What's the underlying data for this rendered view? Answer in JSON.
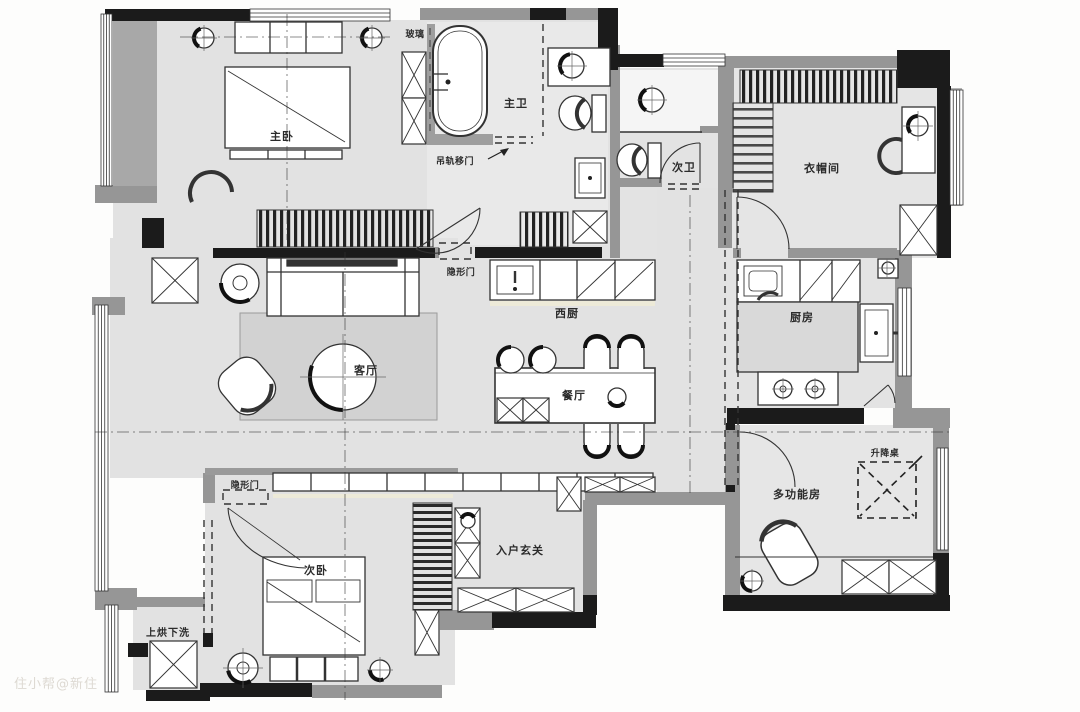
{
  "title": "apartment-floor-plan",
  "watermark": "住小帮@新住",
  "rooms": {
    "master_bedroom": "主卧",
    "master_bath": "主卫",
    "second_bath": "次卫",
    "cloakroom": "衣帽间",
    "living_room": "客厅",
    "west_kitchen": "西厨",
    "dining_room": "餐厅",
    "kitchen": "厨房",
    "multi_function_room": "多功能房",
    "second_bedroom": "次卧",
    "entry_foyer": "入户玄关",
    "laundry": "上烘下洗"
  },
  "annotations": {
    "glass": "玻璃",
    "rail_sliding_door": "吊轨移门",
    "hidden_door_master": "隐形门",
    "hidden_door_second": "隐形门",
    "lift_table": "升降桌"
  },
  "colors": {
    "background": "#fdfdfc",
    "floor": "#e2e2e2",
    "floor_light": "#ececec",
    "wall_gray": "#969696",
    "wall_black": "#1b1b1b",
    "rug": "#d2d2d2",
    "island": "#d9d9d9",
    "accent_yellow": "#edead8",
    "line": "#333333",
    "watermark_color": "#ddd9d2"
  }
}
